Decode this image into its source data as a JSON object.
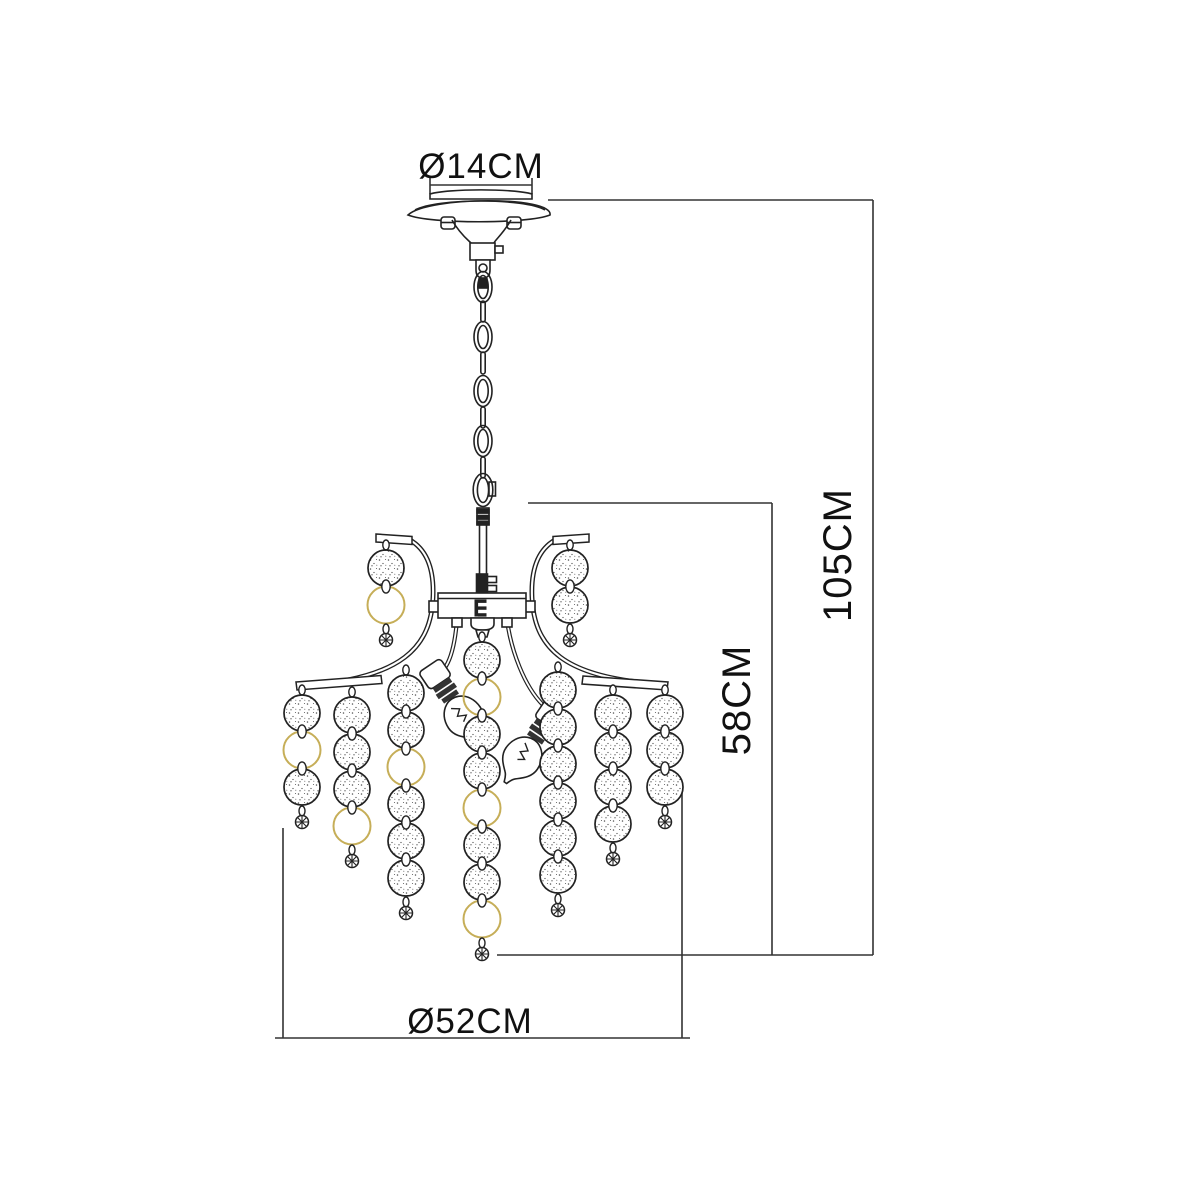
{
  "diagram": {
    "title": "chandelier dimensional drawing",
    "dimensions": {
      "canopy_diameter": "Ø14CM",
      "overall_height": "105CM",
      "body_height": "58CM",
      "body_diameter": "Ø52CM"
    }
  },
  "figure": {
    "colors": {
      "line": "#222222",
      "dim_line": "#333333",
      "gold": "#c6ae58",
      "background": "#ffffff"
    },
    "spacing": 37,
    "bead_radius": 18,
    "strands": [
      {
        "x": 302,
        "top": 713,
        "seq": [
          "bead",
          "ring",
          "bead"
        ]
      },
      {
        "x": 352,
        "top": 715,
        "seq": [
          "bead",
          "bead",
          "bead",
          "ring"
        ]
      },
      {
        "x": 406,
        "top": 693,
        "seq": [
          "bead",
          "bead",
          "ring",
          "bead",
          "bead",
          "bead"
        ]
      },
      {
        "x": 482,
        "top": 660,
        "seq": [
          "bead",
          "ring",
          "bead",
          "bead",
          "ring",
          "bead",
          "bead",
          "ring"
        ]
      },
      {
        "x": 558,
        "top": 690,
        "seq": [
          "bead",
          "bead",
          "bead",
          "bead",
          "bead",
          "bead"
        ]
      },
      {
        "x": 613,
        "top": 713,
        "seq": [
          "bead",
          "bead",
          "bead",
          "bead"
        ]
      },
      {
        "x": 665,
        "top": 713,
        "seq": [
          "bead",
          "bead",
          "bead"
        ]
      },
      {
        "x": 386,
        "top": 568,
        "seq": [
          "bead",
          "ring"
        ]
      },
      {
        "x": 570,
        "top": 568,
        "seq": [
          "bead",
          "bead"
        ]
      }
    ]
  }
}
